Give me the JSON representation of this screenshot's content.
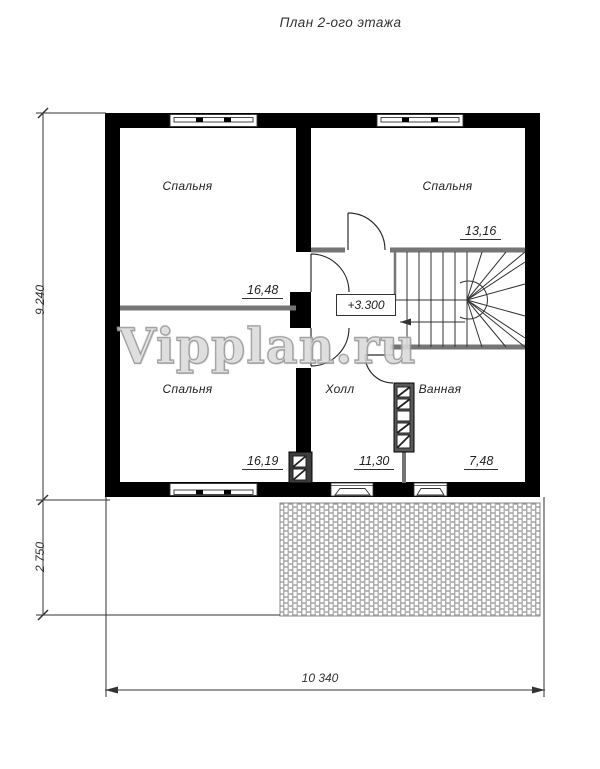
{
  "title": "План 2-ого этажа",
  "watermark": "Vipplan.ru",
  "plan": {
    "rooms": [
      {
        "id": "bedroom-top-left",
        "label": "Спальня",
        "area": "16,48"
      },
      {
        "id": "bedroom-top-right",
        "label": "Спальня",
        "area": "13,16"
      },
      {
        "id": "bedroom-bottom-left",
        "label": "Спальня",
        "area": "16,19"
      },
      {
        "id": "hall",
        "label": "Холл",
        "area": "11,30"
      },
      {
        "id": "bathroom",
        "label": "Ванная",
        "area": "7,48"
      }
    ],
    "elevation_mark": "+3.300"
  },
  "dimensions": {
    "left_total_mm": "9 240",
    "left_lower_mm": "2 750",
    "bottom_total_mm": "10 340"
  },
  "colors": {
    "wall": "#000000",
    "partition": "#757575",
    "line": "#333333",
    "hatch_stroke": "#9a9a9a"
  }
}
